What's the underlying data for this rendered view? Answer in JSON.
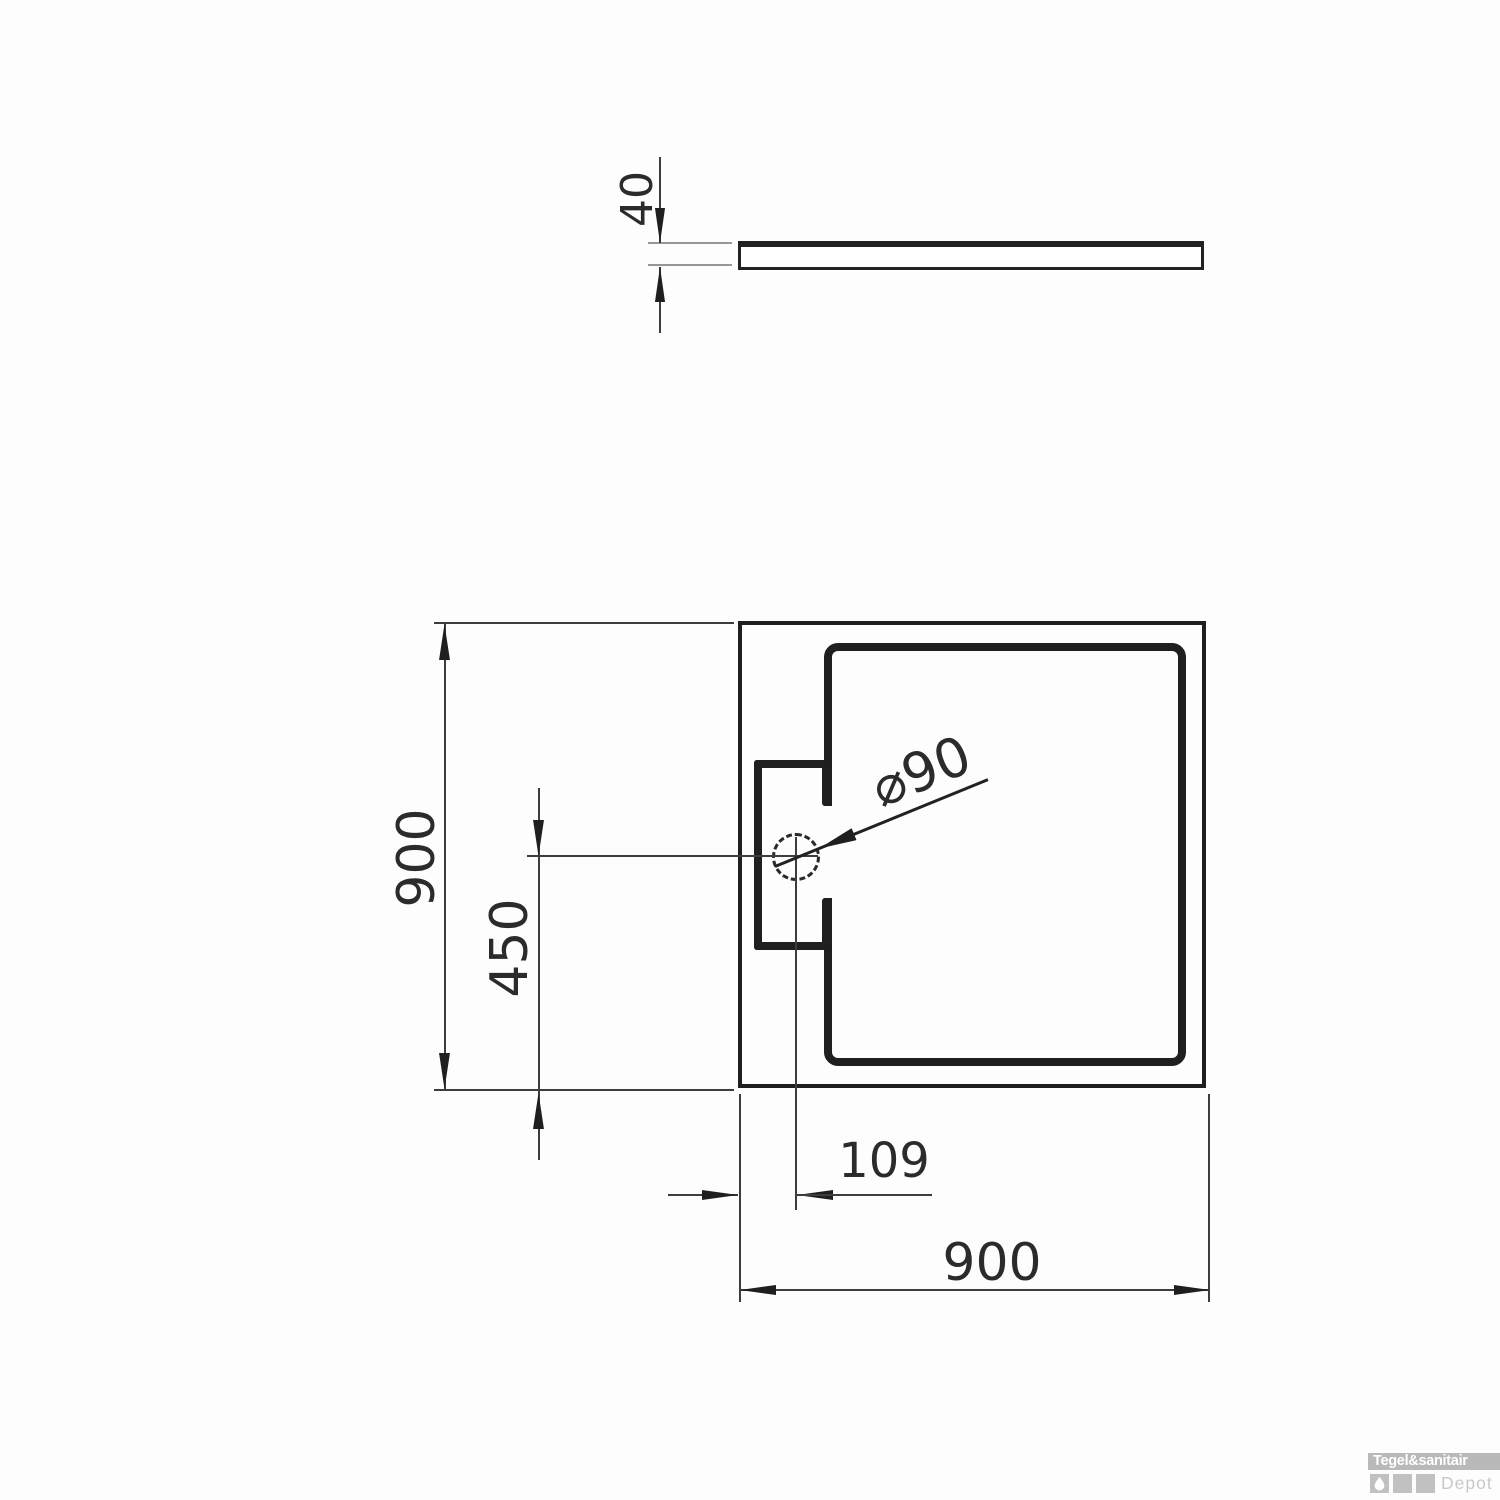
{
  "drawing": {
    "type": "technical-dimension-drawing",
    "subject": "square shower tray, top plan view and side profile view",
    "side_view": {
      "thickness_label": "40"
    },
    "plan_view": {
      "height_label": "900",
      "width_label": "900",
      "drain_vertical_offset_label": "450",
      "drain_horizontal_offset_label": "109",
      "drain_diameter_label": "⌀90"
    }
  },
  "logo": {
    "brand": "Tegel&sanitair",
    "sub": "Depot",
    "bar_color": "#b9b9b9",
    "sub_color": "#c9c9c9"
  },
  "colors": {
    "background": "#fdfdfd",
    "thick_line": "#1f1f1f",
    "thin_line": "#3d3d3d",
    "tick_line": "#979797"
  }
}
